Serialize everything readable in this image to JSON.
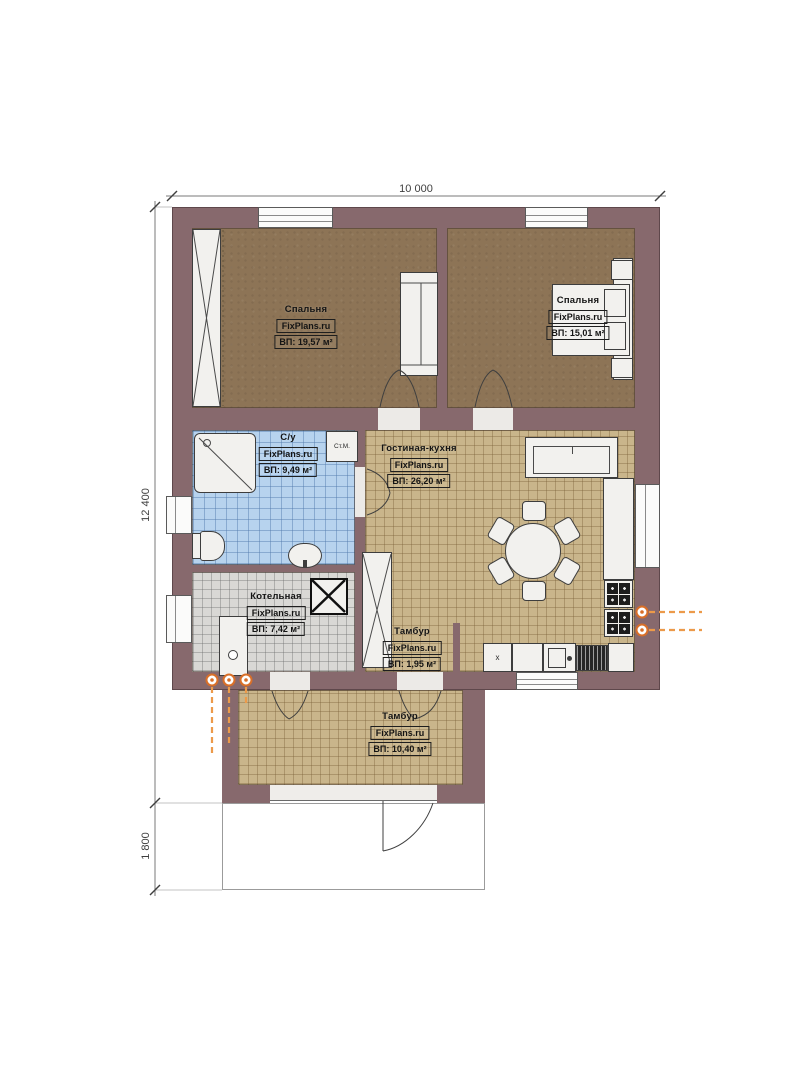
{
  "watermark": "FixPlans.ru",
  "dimensions": {
    "overall_width": "10 000",
    "main_height": "12 400",
    "porch_height": "1 800"
  },
  "rooms": [
    {
      "name": "Спальня",
      "area": "ВП: 19,57 м²"
    },
    {
      "name": "Спальня",
      "area": "ВП: 15,01 м²"
    },
    {
      "name": "С/у",
      "area": "ВП: 9,49 м²"
    },
    {
      "name": "Гостиная-кухня",
      "area": "ВП: 26,20 м²"
    },
    {
      "name": "Котельная",
      "area": "ВП: 7,42 м²"
    },
    {
      "name": "Тамбур",
      "area": "ВП: 1,95 м²"
    },
    {
      "name": "Тамбур",
      "area": "ВП: 10,40 м²"
    }
  ],
  "labels": {
    "washing_machine": "Ст.М.",
    "fridge_mark": "x"
  },
  "colors": {
    "wall": "#87696d",
    "bedroom_floor": "#8d7456",
    "living_tile": "#c9b58b",
    "bath_tile": "#b7d3ee",
    "boiler_tile": "#d9d8d5",
    "gas_accent": "#e0742a"
  }
}
